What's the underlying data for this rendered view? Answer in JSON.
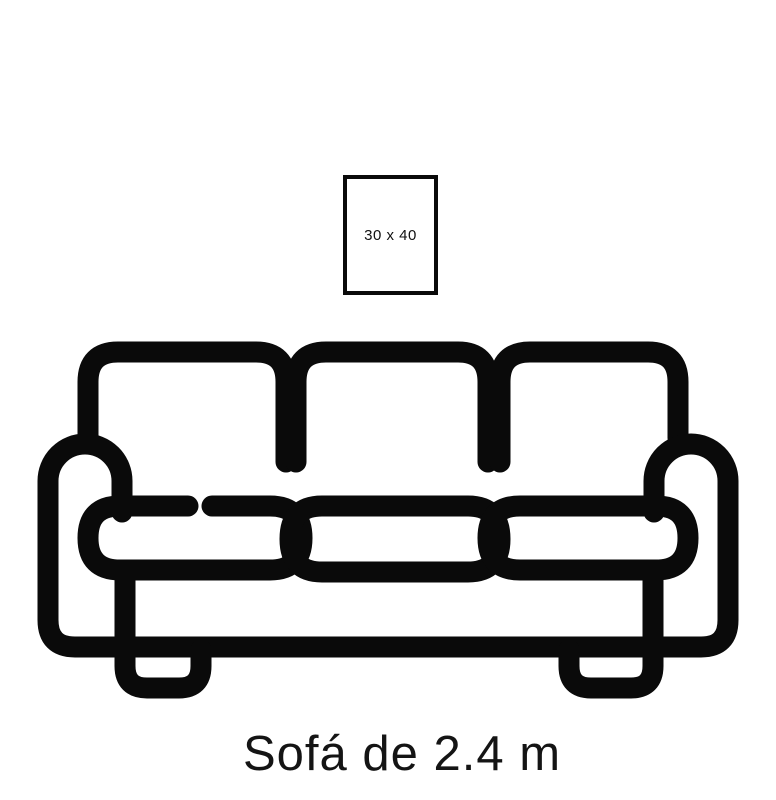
{
  "page": {
    "background": "#ffffff",
    "ink": "#0a0a0a"
  },
  "frame": {
    "label": "30 x 40"
  },
  "caption": {
    "text": "Sofá de 2.4 m"
  }
}
